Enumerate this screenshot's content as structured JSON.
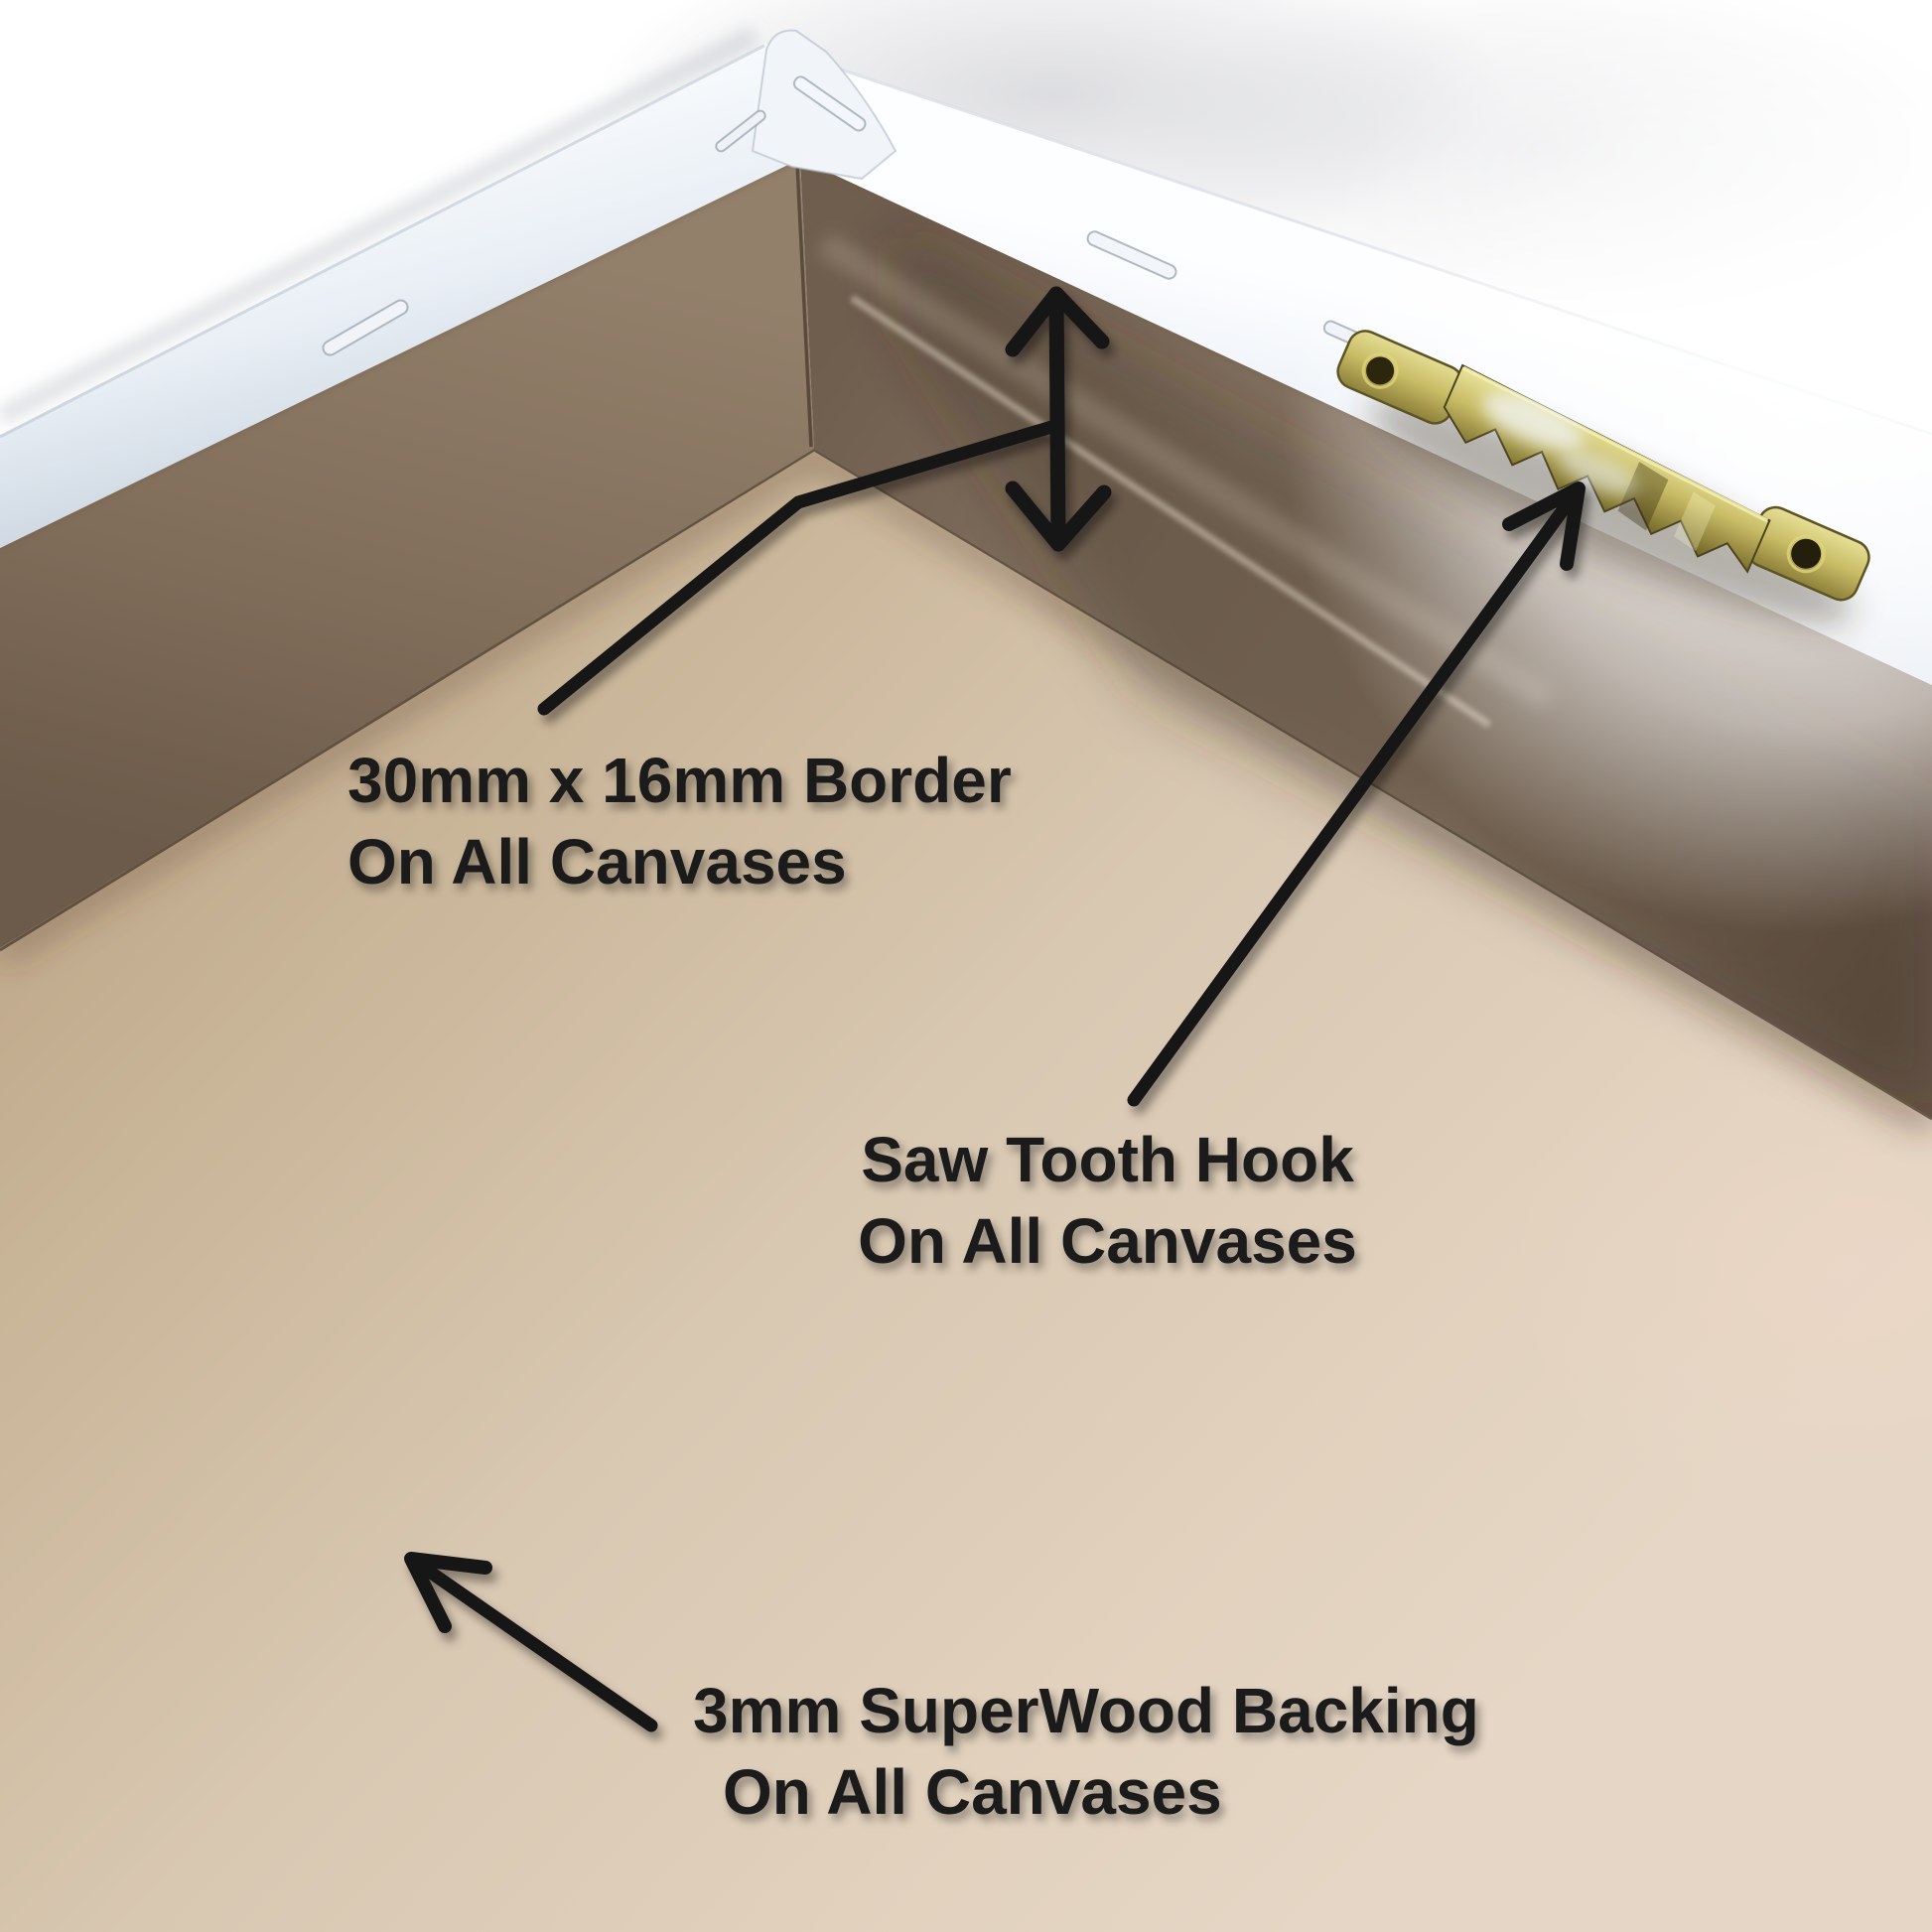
{
  "photo": {
    "subject": "Back corner of a white stretched canvas frame showing border, sawtooth hook and backing board",
    "background_color": "#ffffff",
    "frame_bar_color": "#e9eff5",
    "mdf_border_color": "#82705e",
    "backing_color": "#d6c5b0",
    "hook_color": "#b3a74e"
  },
  "annotations": {
    "arrow_color": "#161616",
    "text_color": "#1b1b1b",
    "labels": {
      "border": {
        "line1": "30mm x 16mm Border",
        "line2": "On All Canvases"
      },
      "saw_tooth_hook": {
        "line1": "Saw Tooth Hook",
        "line2": "On All Canvases"
      },
      "backing": {
        "line1": "3mm SuperWood Backing",
        "line2": "On All Canvases"
      }
    }
  }
}
